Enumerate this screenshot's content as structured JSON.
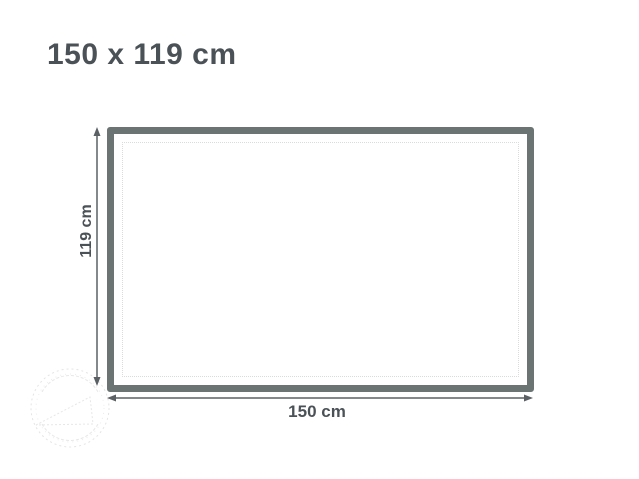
{
  "title": {
    "text": "150 x 119 cm"
  },
  "diagram": {
    "width_label": "150 cm",
    "height_label": "119 cm",
    "dimensions": {
      "width_cm": 150,
      "height_cm": 119
    },
    "colors": {
      "frame_border": "#6b7373",
      "stitch_dots": "#d9dcdc",
      "arrow": "#5a6064",
      "text": "#4b5257",
      "background": "#ffffff",
      "watermark": "#e4e4e4"
    },
    "watermark": {
      "present": true
    }
  }
}
